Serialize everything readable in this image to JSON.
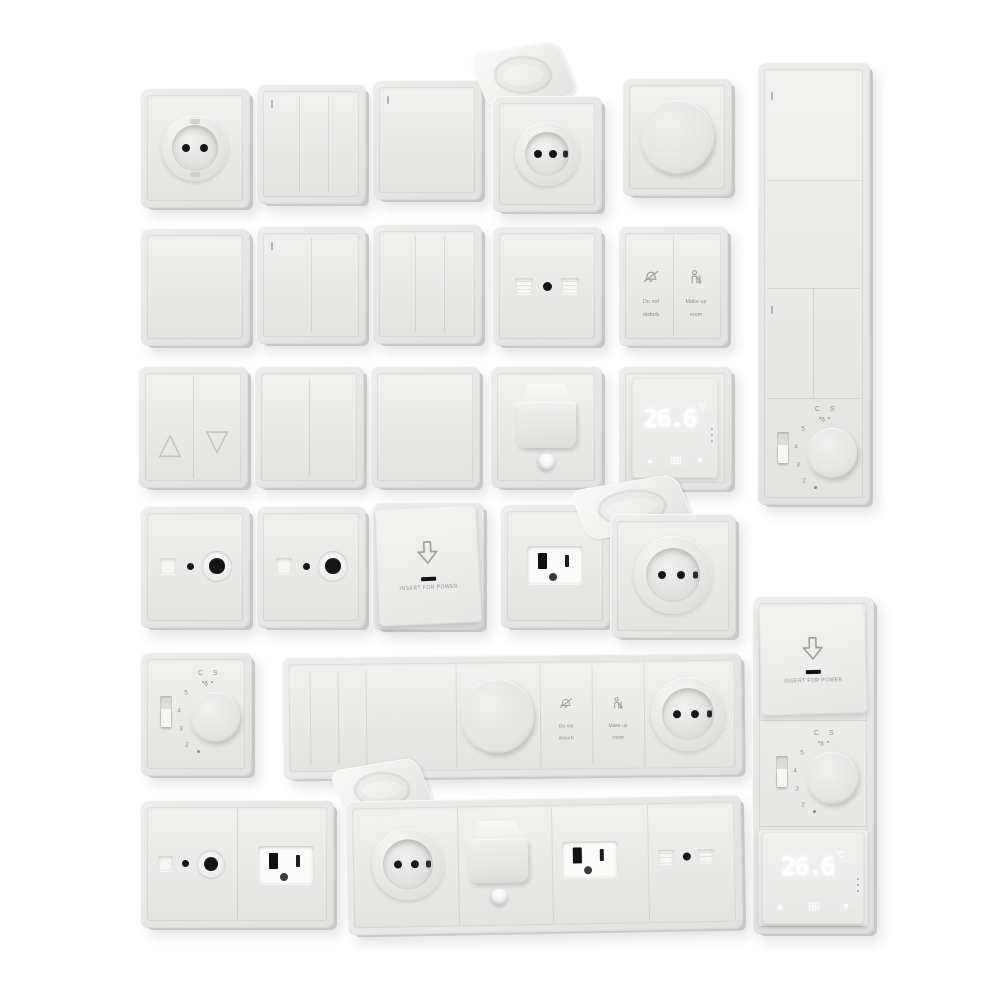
{
  "scene": {
    "subject": "3D render set of white wall switches, sockets and thermostats on a white background",
    "background_color": "#ffffff"
  },
  "palette": {
    "plate_face": "#e8e8e6",
    "plate_edge": "#c7c7c5",
    "recess_hole": "#161616",
    "icon_gray": "#9a9a98",
    "label_gray": "#8c8c8a",
    "indicator_teal": "#a5b8b6",
    "display_digits": "#ffffff"
  },
  "labels": {
    "do_not_disturb": {
      "line1": "Do not",
      "line2": "disturb"
    },
    "make_up_room": {
      "line1": "Make up",
      "line2": "room"
    },
    "insert_for_power": "INSERT FOR POWER"
  },
  "digital_thermostat": {
    "temperature": "26.6",
    "unit": "°C",
    "up_glyph": "▲",
    "down_glyph": "▼"
  },
  "rotary_thermostat": {
    "top_marking": "C S",
    "dial_numbers": [
      "6",
      "5",
      "4",
      "3",
      "2"
    ]
  },
  "blind_switch": {
    "up_glyph": "△",
    "down_glyph": "▽"
  },
  "fixtures": [
    {
      "position": "row1-1",
      "type": "eu-schuko-socket"
    },
    {
      "position": "row1-2",
      "type": "switch-3-gang"
    },
    {
      "position": "row1-3",
      "type": "switch-1-gang"
    },
    {
      "position": "row1-4",
      "type": "eu-socket-flip-lid-open"
    },
    {
      "position": "row1-5",
      "type": "rotary-dimmer"
    },
    {
      "position": "right-column-top",
      "type": "vertical-panel: switch, switch, switch-2-gang, rotary-thermostat"
    },
    {
      "position": "row2-1",
      "type": "blank-switch"
    },
    {
      "position": "row2-2",
      "type": "switch-2-gang"
    },
    {
      "position": "row2-3",
      "type": "switch-3-gang"
    },
    {
      "position": "row2-4",
      "type": "dual-data-socket"
    },
    {
      "position": "row2-5",
      "type": "hotel-service-switch"
    },
    {
      "position": "row3-1",
      "type": "blind-switch-up-down"
    },
    {
      "position": "row3-2",
      "type": "switch-2-gang"
    },
    {
      "position": "row3-3",
      "type": "blank-switch"
    },
    {
      "position": "row3-4",
      "type": "cable-outlet"
    },
    {
      "position": "row3-5",
      "type": "digital-thermostat"
    },
    {
      "position": "row4-1",
      "type": "tv-antenna-socket"
    },
    {
      "position": "row4-2",
      "type": "tv-antenna-socket"
    },
    {
      "position": "row4-3",
      "type": "key-card-power-holder"
    },
    {
      "position": "row4-4",
      "type": "us-socket"
    },
    {
      "position": "row4-5",
      "type": "eu-socket-flip-lid-open"
    },
    {
      "position": "row5-1",
      "type": "rotary-thermostat"
    },
    {
      "position": "row5-2",
      "type": "horizontal-panel: 4-gang-switch, dimmer, hotel-service-switch, eu-socket"
    },
    {
      "position": "row6-1",
      "type": "double-plate: tv-antenna-socket, us-socket"
    },
    {
      "position": "row6-2",
      "type": "horizontal-panel: eu-socket-flip-lid-open, cable-outlet, us-socket, dual-data-socket"
    },
    {
      "position": "right-column-bottom",
      "type": "vertical-panel: key-card-power-holder, rotary-thermostat, digital-thermostat"
    }
  ]
}
